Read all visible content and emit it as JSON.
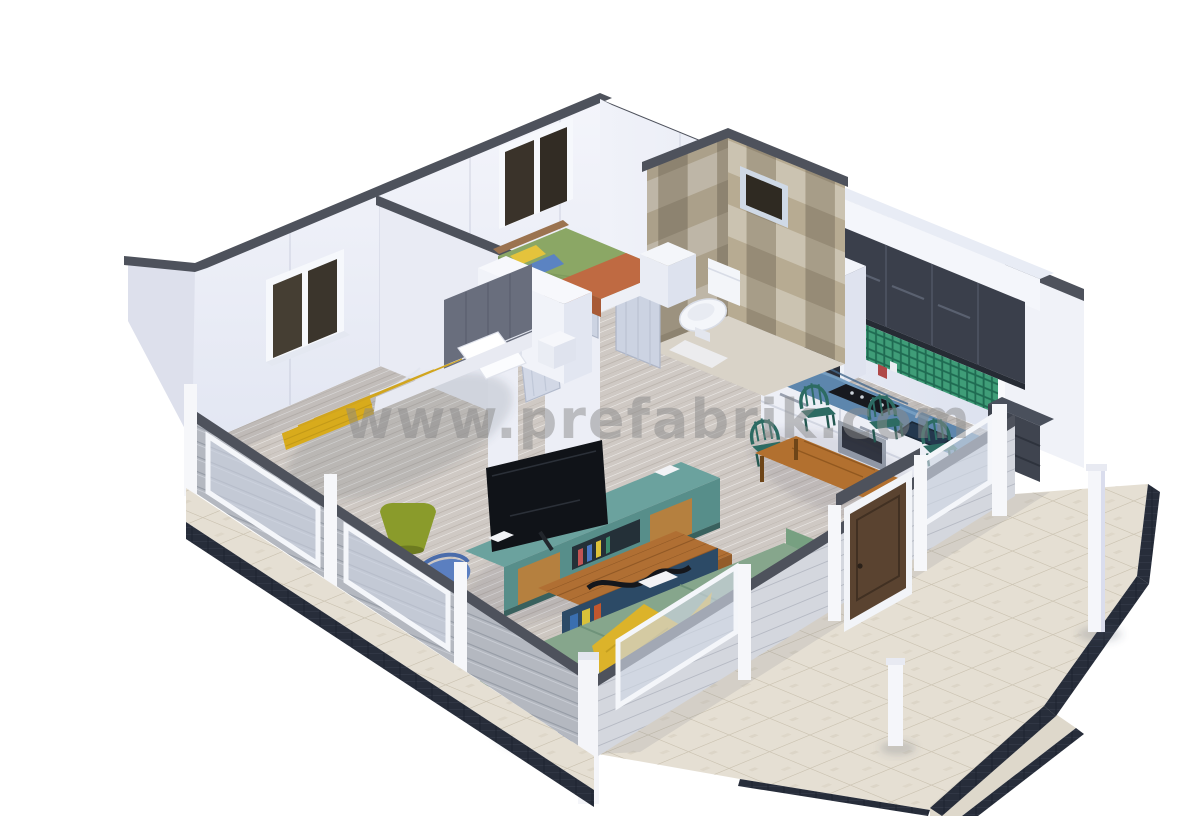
{
  "meta": {
    "title": "3D isometric cutaway render of a one-bedroom prefabricated house",
    "background": "#ffffff"
  },
  "watermark": {
    "text": "www.prefabrik.com",
    "color": "#8b8b8b"
  },
  "palette": {
    "wall": "#eef0f8",
    "wall_cap": "#4e525c",
    "floor_wood": "#cdc7c1",
    "deck_stone": "#e5dfd3",
    "foundation": "#272d3a",
    "siding": "#b4b8c0",
    "bath_tile_light": "#cbc3b1",
    "bath_tile_dark": "#968b76",
    "kitchen_upper": "#3a3f4b",
    "kitchen_counter": "#5d86ad",
    "backsplash": "#2f8d6f",
    "sofa_green": "#86a68c",
    "blanket_yellow": "#e7ba24",
    "kids_bed_green": "#8ba765",
    "kids_blanket_orange": "#bf6a42",
    "tv_stand_teal": "#6ba29e",
    "table_wood": "#b06f33",
    "dining_chair_teal": "#2d6b63",
    "entry_door_brown": "#5a4330",
    "lamp_olive": "#8a9b2b",
    "accent_blue": "#5b7fc0",
    "pillow_yellow": "#e4c33c",
    "pillow_blue": "#2f58b0"
  },
  "scene": {
    "type": "isometric-3d-model",
    "rooms": [
      {
        "name": "master-bedroom",
        "objects": [
          "double-bed",
          "white-pillows",
          "yellow-blanket",
          "upholstered-headboard",
          "wardrobe",
          "window"
        ]
      },
      {
        "name": "kids-bedroom",
        "objects": [
          "single-bed",
          "orange-blanket",
          "yellow-pillow",
          "blue-pillow",
          "dresser",
          "window"
        ]
      },
      {
        "name": "bathroom",
        "objects": [
          "toilet",
          "checkered-tile-walls",
          "window"
        ]
      },
      {
        "name": "kitchen",
        "objects": [
          "upper-cabinets",
          "base-cabinets",
          "blue-countertop",
          "cooktop",
          "oven",
          "microwave",
          "sink",
          "green-mosaic-backsplash"
        ]
      },
      {
        "name": "dining-area",
        "objects": [
          "wooden-table",
          "four-teal-chairs"
        ]
      },
      {
        "name": "living-room",
        "objects": [
          "corner-sofa",
          "yellow-throw",
          "coffee-table",
          "flat-tv",
          "tv-stand",
          "floor-lamp",
          "accent-chair"
        ]
      },
      {
        "name": "exterior",
        "objects": [
          "entry-door",
          "stone-deck",
          "deck-posts",
          "walkway",
          "railing-windows",
          "gray-siding",
          "navy-foundation"
        ]
      }
    ]
  }
}
